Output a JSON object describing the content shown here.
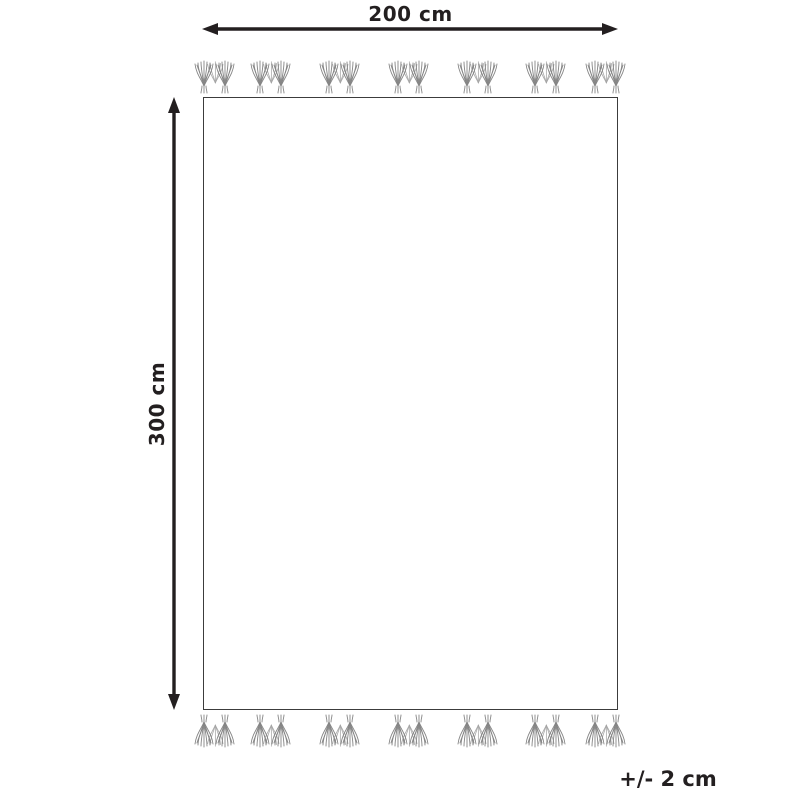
{
  "diagram": {
    "width_label": "200 cm",
    "height_label": "300 cm",
    "tolerance_label": "+/- 2 cm",
    "dimensions": {
      "width_cm": 200,
      "height_cm": 300,
      "tolerance_cm": 2,
      "unit": "cm"
    },
    "tassels": {
      "icon": "tassel-group-icon",
      "top_count": 7,
      "bottom_count": 7,
      "group_centers_px": [
        215,
        271,
        340,
        409,
        478,
        546,
        606
      ]
    },
    "colors": {
      "line": "#231f20",
      "outline": "#3c3c3c",
      "tassel": "#858585",
      "tassel_back": "#a6a6a6",
      "background": "#ffffff"
    }
  }
}
